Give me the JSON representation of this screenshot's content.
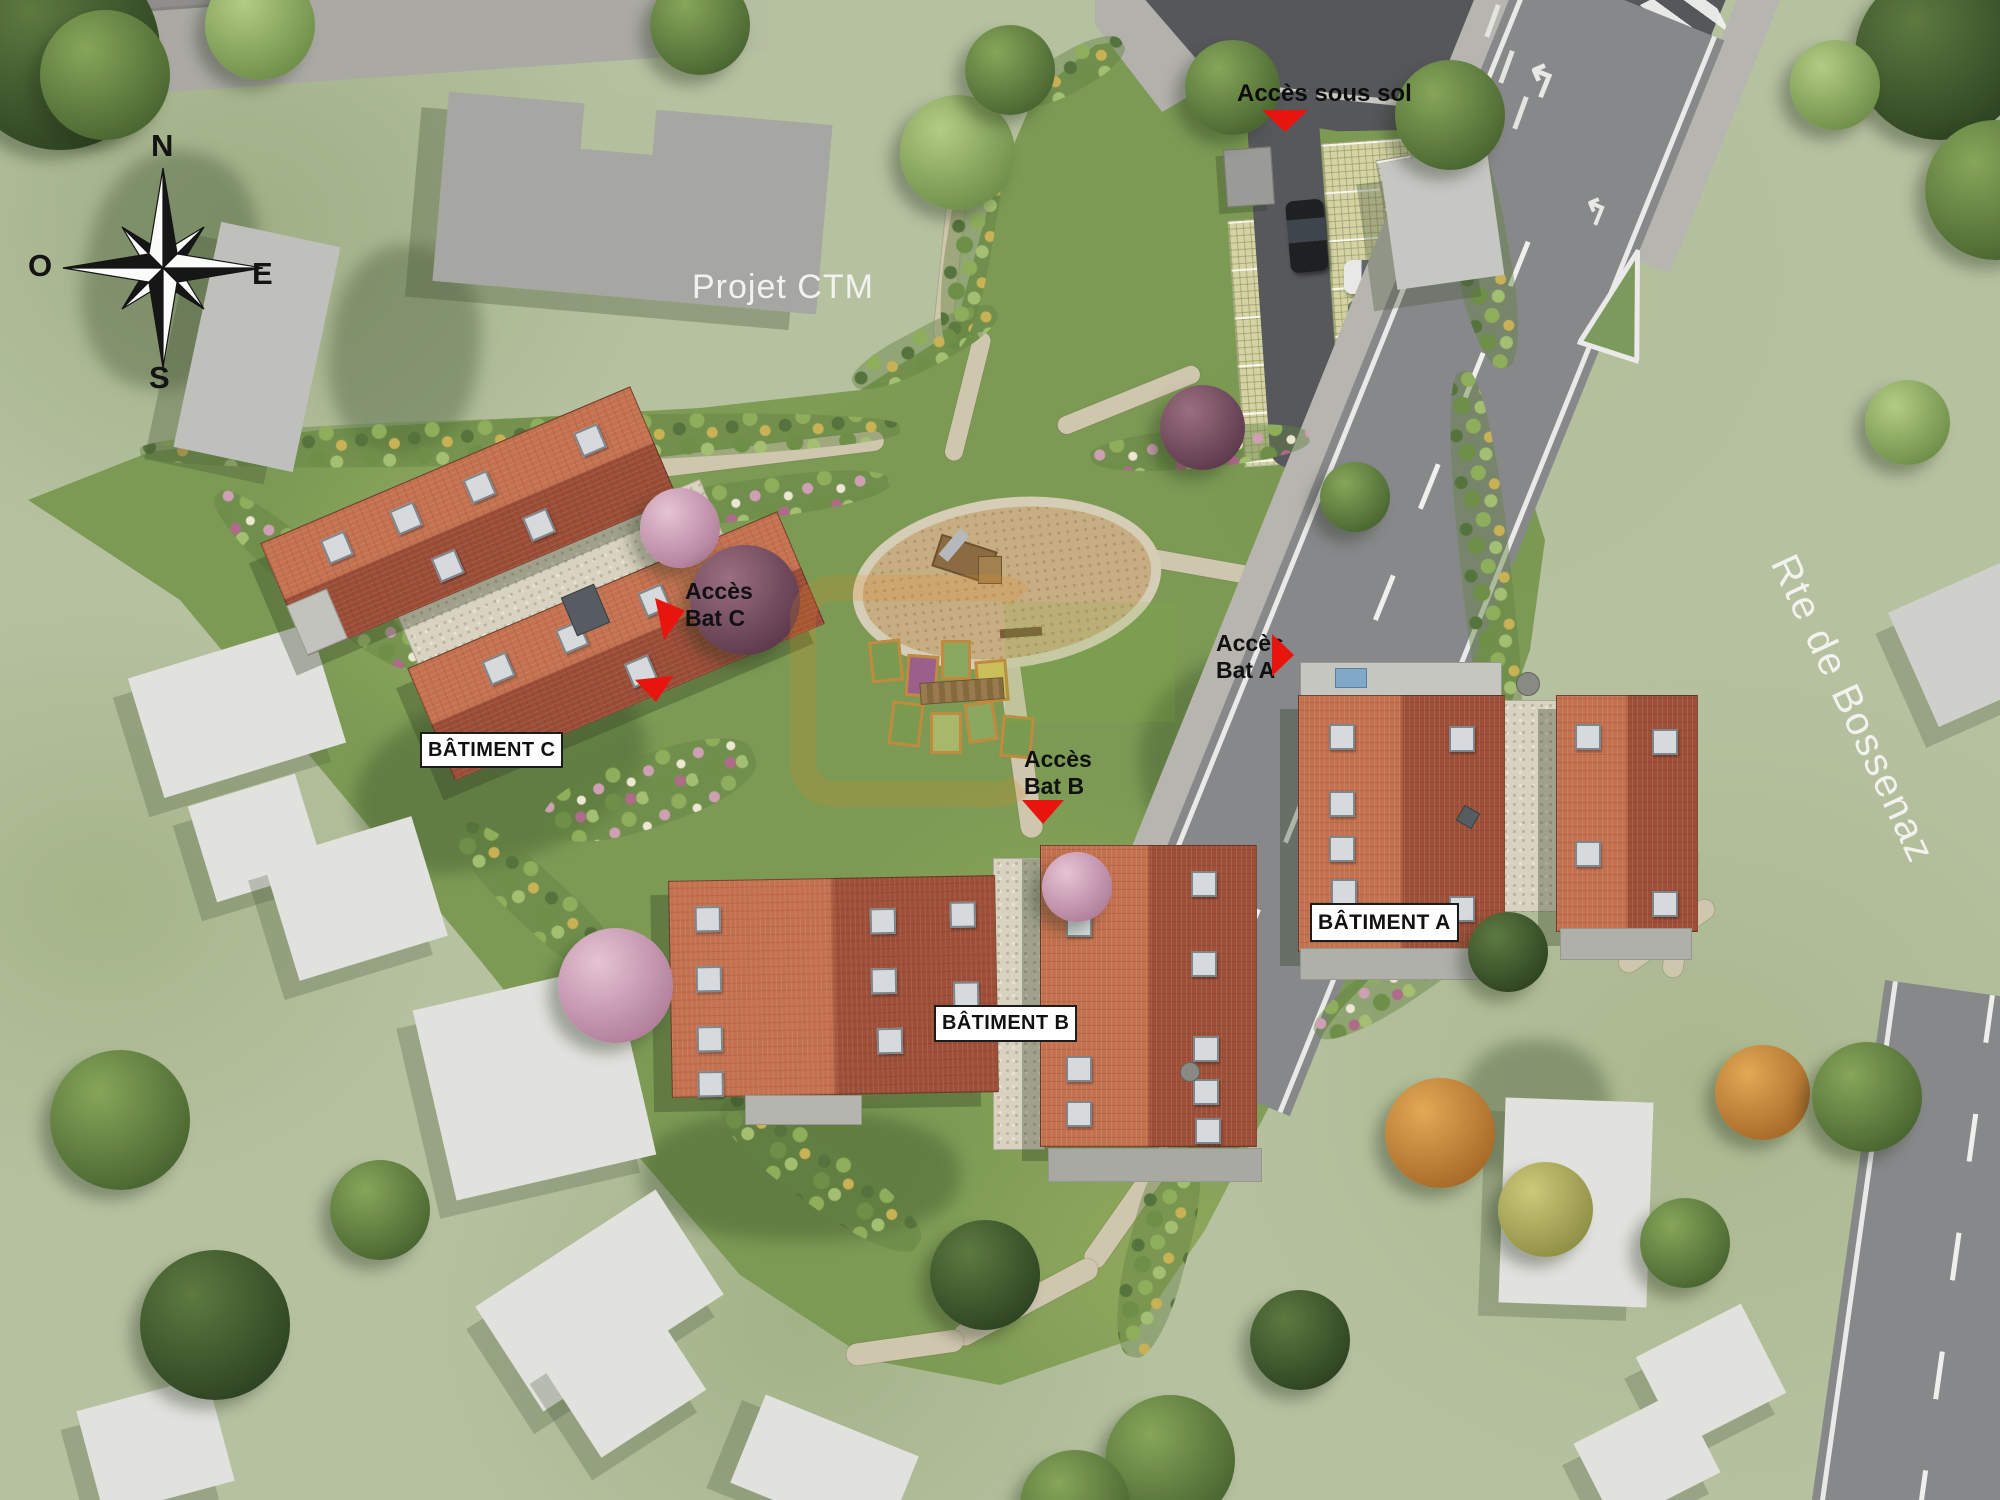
{
  "site_plan": {
    "compass": {
      "north": "N",
      "west": "O",
      "east": "E",
      "south": "S"
    },
    "neighbor_project": {
      "label": "Projet CTM"
    },
    "road": {
      "name": "Rte de Bossenaz"
    },
    "buildings": {
      "a": {
        "label": "BÂTIMENT A"
      },
      "b": {
        "label": "BÂTIMENT B"
      },
      "c": {
        "label": "BÂTIMENT C"
      }
    },
    "access": {
      "sous_sol": {
        "label": "Accès sous sol"
      },
      "bat_a": {
        "line1": "Accès",
        "line2": "Bat A"
      },
      "bat_b": {
        "line1": "Accès",
        "line2": "Bat B"
      },
      "bat_c": {
        "line1": "Accès",
        "line2": "Bat C"
      }
    },
    "colors": {
      "roof_red": "#b45a40",
      "site_green": "#7c9a54",
      "surrounding_green": "#b6c1a0",
      "road_asphalt": "#87888a",
      "junction_asphalt": "#56575a",
      "access_arrow_red": "#e8150e",
      "label_background": "#ffffff",
      "label_border": "#1c1c1c",
      "neighbor_building_gray": "#e1e1dd",
      "ctm_building_gray": "#a6a6a3",
      "gravel": "#d8d2c0",
      "path_tan": "#cfc6ae"
    }
  }
}
